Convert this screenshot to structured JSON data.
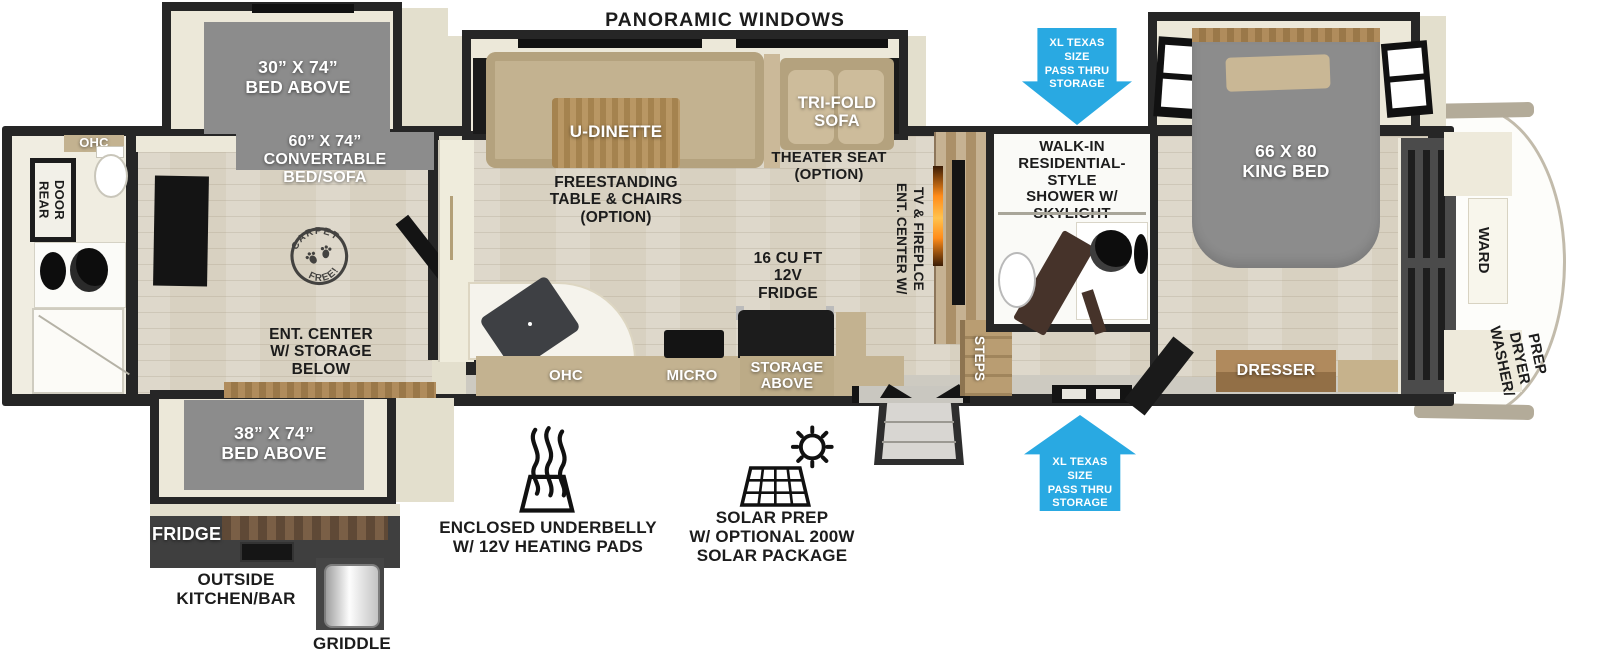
{
  "colors": {
    "wall": "#262626",
    "interior_cream": "#ece8d9",
    "floor_wood": "#d8d1c1",
    "slideout_bed_gray": "#8c8c8c",
    "furniture_tan": "#c3b290",
    "cabinet_wood": "#a8865a",
    "storage_arrow_blue": "#29a9e2",
    "dark_cabinet": "#4b4b4b",
    "fireplace_flame": "#ff8c1a",
    "label_black": "#1c1c1c",
    "label_white": "#ffffff"
  },
  "header": {
    "panoramic_windows": "PANORAMIC WINDOWS"
  },
  "storage_arrows": {
    "top": "XL TEXAS SIZE\nPASS THRU\nSTORAGE",
    "bottom": "XL TEXAS SIZE\nPASS THRU\nSTORAGE"
  },
  "rear_bath": {
    "ohc": "OHC",
    "rear_door": "REAR DOOR"
  },
  "bunk_room": {
    "bed_above": "30” X 74”\nBED ABOVE",
    "convertible_bed": "60” X 74”\nCONVERTABLE\nBED/SOFA",
    "carpet_stamp": {
      "top": "CARPET",
      "bottom": "FREE!"
    },
    "ent_center": "ENT. CENTER\nW/ STORAGE\nBELOW",
    "bed_above_lower": "38” X 74”\nBED ABOVE"
  },
  "outside_kitchen": {
    "fridge": "FRIDGE",
    "label": "OUTSIDE\nKITCHEN/BAR",
    "griddle": "GRIDDLE"
  },
  "living_room": {
    "u_dinette": "U-DINETTE",
    "table_option": "FREESTANDING\nTABLE & CHAIRS\n(OPTION)",
    "sofa": "TRI-FOLD\nSOFA",
    "theater_seat": "THEATER SEAT\n(OPTION)",
    "ent_center": "ENT. CENTER W/\nTV & FIREPLCE"
  },
  "kitchen": {
    "fridge": "16 CU FT\n12V\nFRIDGE",
    "ohc": "OHC",
    "micro": "MICRO",
    "storage": "STORAGE\nABOVE"
  },
  "mid_bath": {
    "shower": "WALK-IN\nRESIDENTIAL-STYLE\nSHOWER W/\nSKYLIGHT",
    "steps": "STEPS"
  },
  "bedroom": {
    "bed": "66 X 80\nKING BED",
    "dresser": "DRESSER",
    "ward": "WARD",
    "washer_dryer": "WASHER/\nDRYER\nPREP"
  },
  "features": {
    "underbelly": "ENCLOSED UNDERBELLY\nW/ 12V HEATING PADS",
    "solar": "SOLAR PREP\nW/ OPTIONAL 200W\nSOLAR PACKAGE"
  }
}
